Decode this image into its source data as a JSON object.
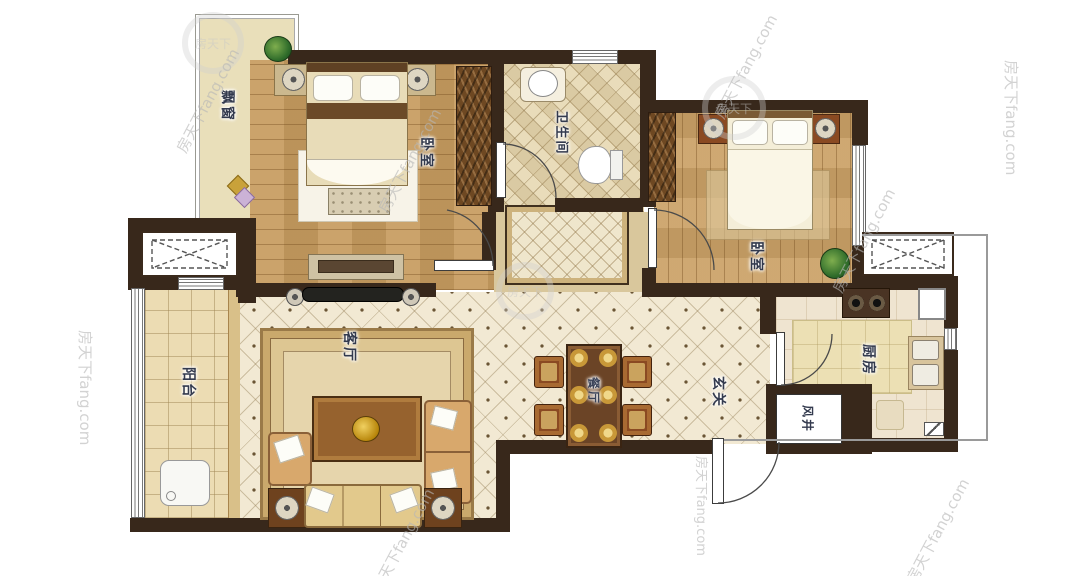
{
  "title": "apartment-floor-plan",
  "watermark": {
    "text": "房天下fang.com",
    "brand": "房天下"
  },
  "rooms": {
    "bay_window": {
      "label": "飘窗"
    },
    "bedroom_left": {
      "label": "卧室"
    },
    "bathroom": {
      "label": "卫生间"
    },
    "bedroom_right": {
      "label": "卧室"
    },
    "living_room": {
      "label": "客厅"
    },
    "dining_room": {
      "label": "餐厅"
    },
    "entry": {
      "label": "玄关"
    },
    "kitchen": {
      "label": "厨房"
    },
    "balcony": {
      "label": "阳台"
    },
    "air_shaft": {
      "label": "风井"
    }
  },
  "colors": {
    "wall": "#38281b",
    "wood_floor": "#c79c60",
    "tile_floor": "#f2e9d3",
    "bathroom_floor": "#e9dcba",
    "balcony_floor": "#ecdcb3",
    "kitchen_floor": "#efe4d0",
    "bay_floor": "#e9dfba",
    "label_text": "#333a4e"
  }
}
